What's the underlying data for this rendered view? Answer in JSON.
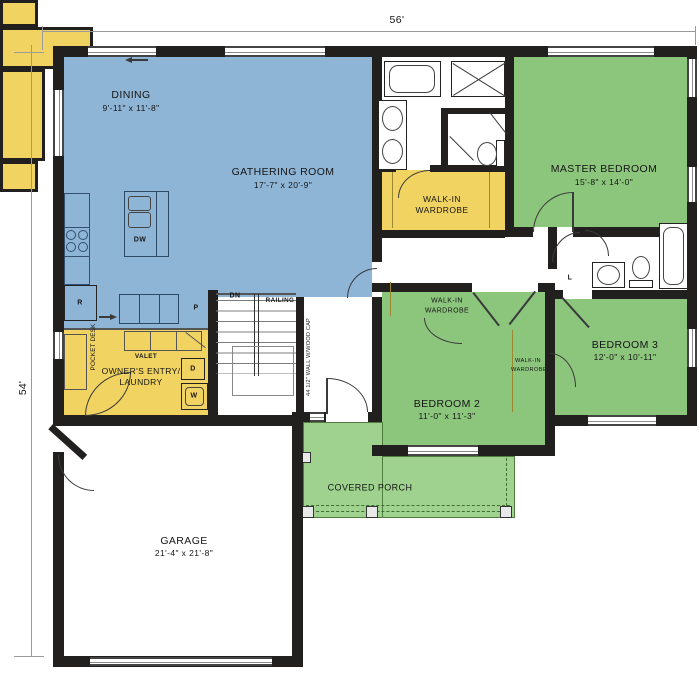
{
  "dimensions": {
    "top": "56'",
    "left": "54'"
  },
  "rooms": {
    "dining": {
      "name": "DINING",
      "size": "9'-11\" x 11'-8\""
    },
    "gathering_room": {
      "name": "GATHERING ROOM",
      "size": "17'-7\" x 20'-9\""
    },
    "master_bedroom": {
      "name": "MASTER BEDROOM",
      "size": "15'-8\" x 14'-0\""
    },
    "bedroom_2": {
      "name": "BEDROOM 2",
      "size": "11'-0\" x 11'-3\""
    },
    "bedroom_3": {
      "name": "BEDROOM 3",
      "size": "12'-0\" x 10'-11\""
    },
    "garage": {
      "name": "GARAGE",
      "size": "21'-4\" x 21'-8\""
    },
    "covered_porch": {
      "name": "COVERED PORCH"
    },
    "owners_entry": {
      "name_line1": "OWNER'S ENTRY/",
      "name_line2": "LAUNDRY"
    },
    "master_wardrobe": {
      "name_line1": "WALK-IN",
      "name_line2": "WARDROBE"
    },
    "bedroom2_wardrobe": {
      "name_line1": "WALK-IN",
      "name_line2": "WARDROBE"
    },
    "bedroom3_wardrobe": {
      "name_line1": "WALK-IN",
      "name_line2": "WARDROBE"
    }
  },
  "annotations": {
    "down": "DN",
    "railing": "RAILING",
    "wall_note": "44 1/2\" WALL W/WOOD CAP",
    "valet": "VALET",
    "pocket_desk": "POCKET DESK"
  },
  "fixtures": {
    "refrigerator": "R",
    "dishwasher": "DW",
    "pantry": "P",
    "dryer": "D",
    "washer": "W",
    "linen": "L"
  },
  "colors": {
    "living_area": "#8fb5d6",
    "bedroom_area": "#8cc57c",
    "porch_area": "#9ed28e",
    "storage_area": "#f0d361",
    "wall": "#221f1f"
  }
}
